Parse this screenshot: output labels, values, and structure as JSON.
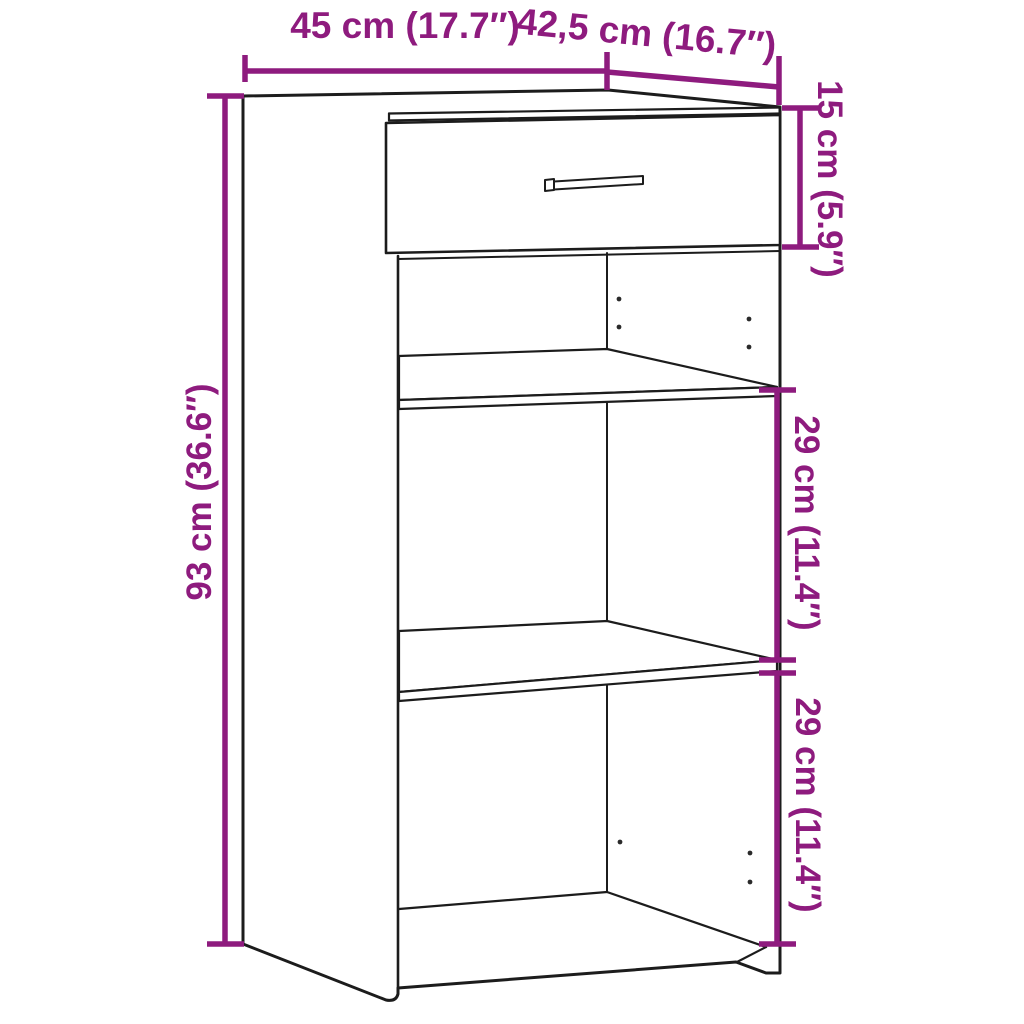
{
  "diagram": {
    "type": "furniture-dimension-diagram",
    "object": "sideboard with one drawer and two open shelf compartments",
    "units": [
      "cm",
      "inches"
    ],
    "dimensions": {
      "width": {
        "label": "45 cm (17.7″)",
        "cm": 45,
        "inches": 17.7,
        "measures": "top width (front edge)"
      },
      "depth": {
        "label": "42,5 cm (16.7″)",
        "cm": 42.5,
        "inches": 16.7,
        "measures": "top depth (side edge)"
      },
      "drawer": {
        "label": "15 cm (5.9″)",
        "cm": 15,
        "inches": 5.9,
        "measures": "drawer front height"
      },
      "height": {
        "label": "93 cm (36.6″)",
        "cm": 93,
        "inches": 36.6,
        "measures": "total height"
      },
      "compartment_upper": {
        "label": "29 cm (11.4″)",
        "cm": 29,
        "inches": 11.4,
        "measures": "middle compartment height"
      },
      "compartment_lower": {
        "label": "29 cm (11.4″)",
        "cm": 29,
        "inches": 11.4,
        "measures": "bottom compartment height"
      }
    }
  },
  "colors": {
    "dimension_accent": "#8E1B7E",
    "outline": "#1C1C1C",
    "background": "#FFFFFF"
  }
}
